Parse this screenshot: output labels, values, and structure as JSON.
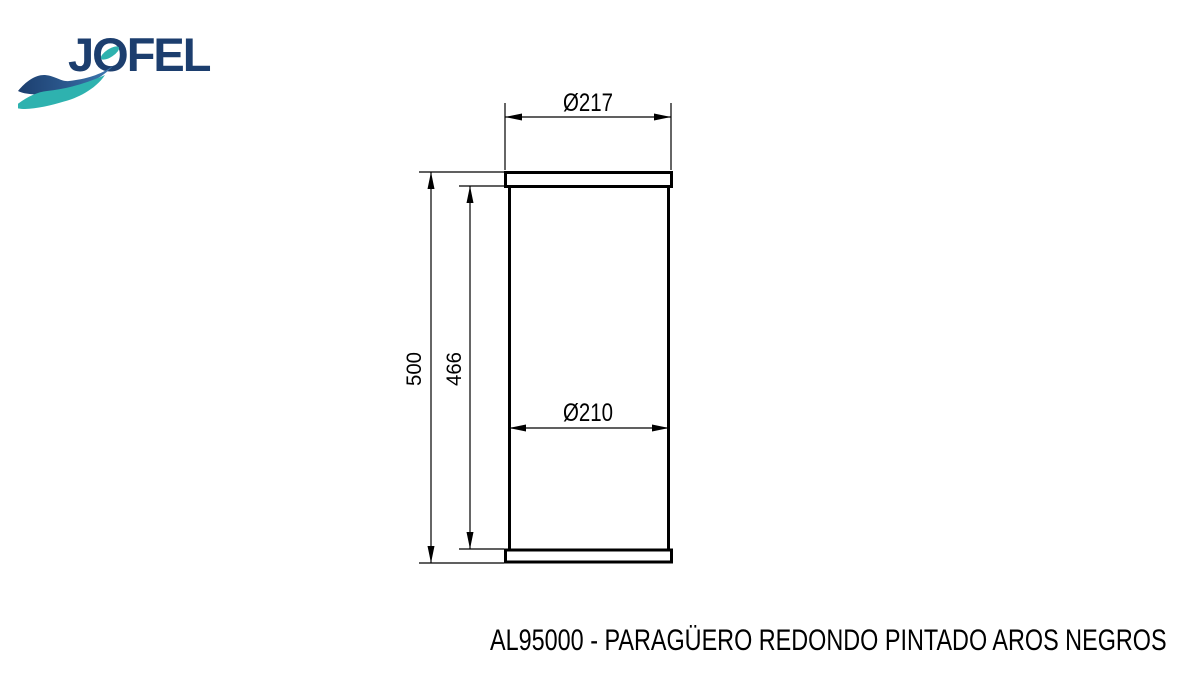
{
  "logo": {
    "brand": "JOFEL",
    "colors": {
      "navy": "#1c3e6e",
      "blue": "#3f7ab2",
      "teal": "#2eb2af"
    }
  },
  "drawing": {
    "type": "technical-dimension-drawing",
    "subject": "cylindrical umbrella stand, front elevation",
    "line_color": "#000000",
    "background": "#ffffff",
    "dimensions": {
      "top_diameter": "Ø217",
      "body_diameter": "Ø210",
      "overall_height": "500",
      "body_height": "466"
    }
  },
  "caption": {
    "text": "AL95000 - PARAGÜERO REDONDO PINTADO AROS NEGROS"
  }
}
